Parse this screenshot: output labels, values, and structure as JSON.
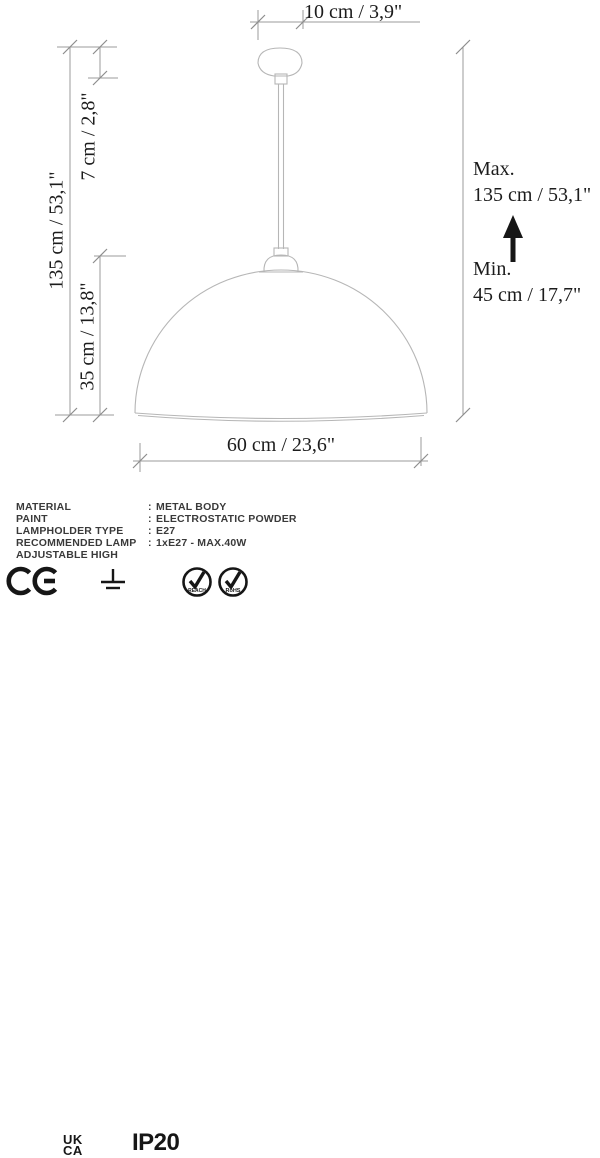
{
  "drawing": {
    "dim_top": "10 cm / 3,9\"",
    "dim_left_total": "135 cm / 53,1\"",
    "dim_left_canopy": "7 cm / 2,8\"",
    "dim_left_shade": "35 cm / 13,8\"",
    "dim_right_max_label": "Max.",
    "dim_right_max_value": "135 cm / 53,1\"",
    "dim_right_min_label": "Min.",
    "dim_right_min_value": "45 cm / 17,7\"",
    "dim_bottom": "60 cm / 23,6\""
  },
  "specs": {
    "rows": [
      {
        "label": "MATERIAL",
        "sep": ":",
        "value": "METAL BODY"
      },
      {
        "label": "PAINT",
        "sep": ":",
        "value": "ELECTROSTATIC POWDER"
      },
      {
        "label": "LAMPHOLDER TYPE",
        "sep": ":",
        "value": "E27"
      },
      {
        "label": "RECOMMENDED LAMP",
        "sep": ":",
        "value": "1xE27 - MAX.40W"
      },
      {
        "label": "ADJUSTABLE HIGH",
        "sep": "",
        "value": ""
      }
    ]
  },
  "certifications": {
    "ukca_line1": "UK",
    "ukca_line2": "CA",
    "ip_rating": "IP20",
    "badge1": "REACH",
    "badge2": "RoHS",
    "icons": [
      "ce-mark-icon",
      "ukca-mark-icon",
      "earth-ground-icon",
      "reach-badge-icon",
      "rohs-badge-icon"
    ]
  },
  "colors": {
    "outline_gray": "#b6b6b6",
    "dimension_gray": "#9b9b9b",
    "text_black": "#1c1c1c",
    "spec_gray": "#3a3a3a"
  }
}
